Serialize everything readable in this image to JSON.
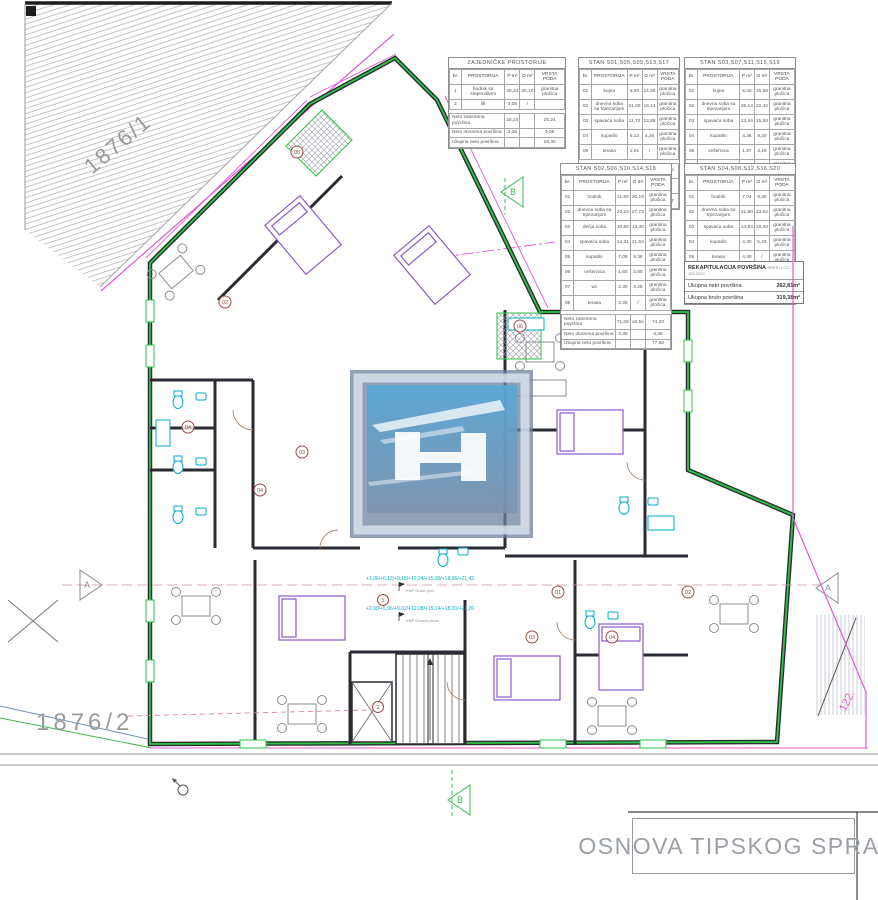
{
  "title_block": {
    "text": "OSNOVA TIPSKOG SPRATA"
  },
  "parcels": {
    "upper": "1876/1",
    "lower": "1876/2",
    "right": "122."
  },
  "markers": {
    "a": "A",
    "b": "B"
  },
  "levels": {
    "line1": "+3,06/+6,12/+9,18/+12,24/+15,30/+18,36/+21,42",
    "line1_sub": "KNP  Gotov pod",
    "line2": "+2,90/+5,96/+9,02/+12,08/+15,14/+18,20/+21,26",
    "line2_sub": "KNP  Gotova ploča"
  },
  "plan": {
    "room_badges": [
      {
        "n": "05"
      },
      {
        "n": "02"
      },
      {
        "n": "06"
      },
      {
        "n": "03"
      },
      {
        "n": "04"
      },
      {
        "n": "04"
      },
      {
        "n": "1"
      },
      {
        "n": "2"
      },
      {
        "n": "01"
      },
      {
        "n": "02"
      },
      {
        "n": "03"
      },
      {
        "n": "04"
      }
    ]
  },
  "tables": {
    "zajednicke": {
      "title": "ZAJEDNIČKE PROSTORIJE",
      "headers": [
        "br.",
        "PROSTORIJA",
        "P m²",
        "O m²",
        "VRSTA PODA"
      ],
      "rows": [
        [
          "1",
          "hodnik sa stepeništem",
          "25,24",
          "30,10",
          "granitna pločica"
        ],
        [
          "2",
          "lift",
          "3,06",
          "/",
          ""
        ]
      ],
      "footer": [
        [
          "Neto zatvorena površina",
          "25,24",
          "",
          "25,24"
        ],
        [
          "Neto otvorena površina",
          "3,06",
          "",
          "3,06"
        ],
        [
          "Ukupna neto površina",
          "",
          "",
          "28,30"
        ]
      ]
    },
    "stan1": {
      "title": "STAN S01,S05,S09,S13,S17",
      "headers": [
        "br.",
        "PROSTORIJA",
        "P m²",
        "O m²",
        "VRSTA PODA"
      ],
      "rows": [
        [
          "01",
          "kujna",
          "5,92",
          "14,56",
          "granitna pločica"
        ],
        [
          "02",
          "dnevna soba sa trpezarijom",
          "21,09",
          "19,14",
          "granitna pločica"
        ],
        [
          "03",
          "spavaća soba",
          "11,72",
          "13,88",
          "granitna pločica"
        ],
        [
          "04",
          "kupatilo",
          "5,13",
          "4,26",
          "granitna pločica"
        ],
        [
          "05",
          "terasa",
          "2,81",
          "/",
          "granitna pločica"
        ]
      ],
      "footer": [
        [
          "Neto zatvorena površina",
          "43,86",
          "x0,5x",
          "43,86"
        ],
        [
          "Neto otvorena površina",
          "2,81",
          "",
          "2,81"
        ],
        [
          "Ukupna neto površina",
          "",
          "",
          "46,67"
        ]
      ]
    },
    "stan3": {
      "title": "STAN S03,S07,S11,S15,S19",
      "headers": [
        "br.",
        "PROSTORIJA",
        "P m²",
        "O m²",
        "VRSTA PODA"
      ],
      "rows": [
        [
          "01",
          "kujna",
          "5,40",
          "15,58",
          "granitna pločica"
        ],
        [
          "02",
          "dnevna soba sa trpezarijom",
          "25,14",
          "22,42",
          "granitna pločica"
        ],
        [
          "03",
          "spavaća soba",
          "13,44",
          "15,88",
          "granitna pločica"
        ],
        [
          "04",
          "kupatilo",
          "4,36",
          "8,20",
          "granitna pločica"
        ],
        [
          "05",
          "vešernica",
          "1,97",
          "3,16",
          "granitna pločica"
        ],
        [
          "06",
          "terasa",
          "4,87",
          "/",
          "granitna pločica"
        ]
      ],
      "footer": [
        [
          "Neto zatvorena površina",
          "50,31",
          "x0,5x",
          "51,17"
        ],
        [
          "Neto otvorena površina",
          "4,87",
          "",
          "4,87"
        ],
        [
          "Ukupna neto površina",
          "",
          "",
          "56,04"
        ]
      ]
    },
    "stan2": {
      "title": "STAN S02,S06,S10,S14,S18",
      "headers": [
        "br.",
        "PROSTORIJA",
        "P m²",
        "O m²",
        "VRSTA PODA"
      ],
      "rows": [
        [
          "01",
          "hodnik",
          "11,83",
          "20,19",
          "granitna pločica"
        ],
        [
          "02",
          "dnevna soba sa trpezarijom",
          "23,24",
          "27,73",
          "granitna pločica"
        ],
        [
          "03",
          "dečja soba",
          "10,80",
          "13,30",
          "granitna pločica"
        ],
        [
          "04",
          "spavaća soba",
          "14,21",
          "21,54",
          "granitna pločica"
        ],
        [
          "05",
          "kupatilo",
          "7,08",
          "9,38",
          "granitna pločica"
        ],
        [
          "06",
          "vešernica",
          "1,60",
          "2,80",
          "granitna pločica"
        ],
        [
          "07",
          "wc",
          "2,30",
          "4,25",
          "granitna pločica"
        ],
        [
          "08",
          "terasa",
          "3,36",
          "/",
          "granitna pločica"
        ]
      ],
      "footer": [
        [
          "Neto zatvorena površina",
          "71,06",
          "x0,5x",
          "74,23"
        ],
        [
          "Neto otvorena površina",
          "3,36",
          "",
          "3,36"
        ],
        [
          "Ukupna neto površina",
          "",
          "",
          "77,59"
        ]
      ]
    },
    "stan4": {
      "title": "STAN S04,S08,S12,S16,S20",
      "headers": [
        "br.",
        "PROSTORIJA",
        "P m²",
        "O m²",
        "VRSTA PODA"
      ],
      "rows": [
        [
          "01",
          "hodnik",
          "7,04",
          "9,30",
          "granitna pločica"
        ],
        [
          "02",
          "dnevna soba sa trpezarijom",
          "21,80",
          "23,62",
          "granitna pločica"
        ],
        [
          "03",
          "spavaća soba",
          "14,84",
          "18,40",
          "granitna pločica"
        ],
        [
          "04",
          "kupatilo",
          "4,30",
          "5,43",
          "granitna pločica"
        ],
        [
          "05",
          "terasa",
          "4,40",
          "/",
          "granitna pločica"
        ]
      ],
      "footer": [
        [
          "Neto zatvorena površina",
          "44,04",
          "x0,5x",
          "44,20"
        ],
        [
          "Neto otvorena površina",
          "4,40",
          "",
          "4,40"
        ],
        [
          "Ukupna neto površina",
          "",
          "",
          "48,60"
        ]
      ]
    },
    "rekap": {
      "title": "REKAPITULACIJA POVRŠINA",
      "title_small": "SRPS U.C2. 100:2002",
      "rows": [
        {
          "label": "Ukupna neto površina",
          "value": "262,81m²"
        },
        {
          "label": "Ukupna bruto površina",
          "value": "319,38m²"
        }
      ]
    }
  },
  "colors": {
    "wall_green": "#2ec247",
    "boundary_magenta": "#e05ad5",
    "fixture_cyan": "#00aec6",
    "furniture_purple": "#8a5bc7",
    "annotation_cyan": "#00b2cc",
    "badge_red": "#a04848",
    "logo_blue": "#54a8d8"
  }
}
